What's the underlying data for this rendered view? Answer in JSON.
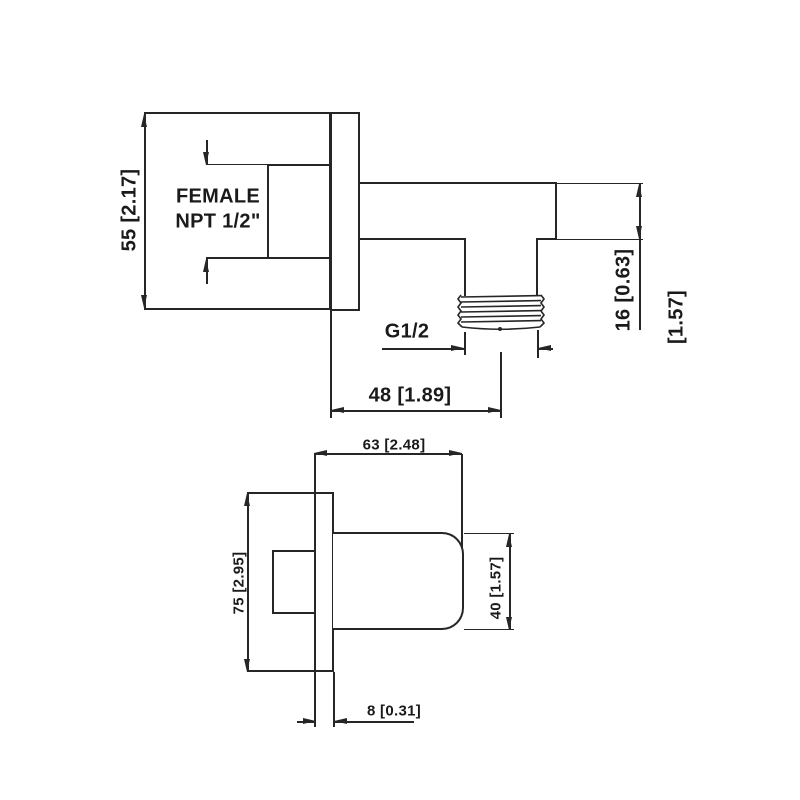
{
  "page": {
    "background": "#ffffff",
    "line_color": "#262626",
    "text_color": "#1a1a1a"
  },
  "top_view": {
    "port_label_line1": "FEMALE",
    "port_label_line2": "NPT 1/2\"",
    "dims": {
      "plate_height": "55 [2.17]",
      "spout_height": "16 [0.63]",
      "overall_depth_ref": "[1.57]",
      "outlet_thread": "G1/2",
      "outlet_offset": "48 [1.89]"
    }
  },
  "front_view": {
    "dims": {
      "body_length": "63 [2.48]",
      "plate_height": "75 [2.95]",
      "body_height": "40 [1.57]",
      "plate_thickness": "8 [0.31]"
    }
  }
}
